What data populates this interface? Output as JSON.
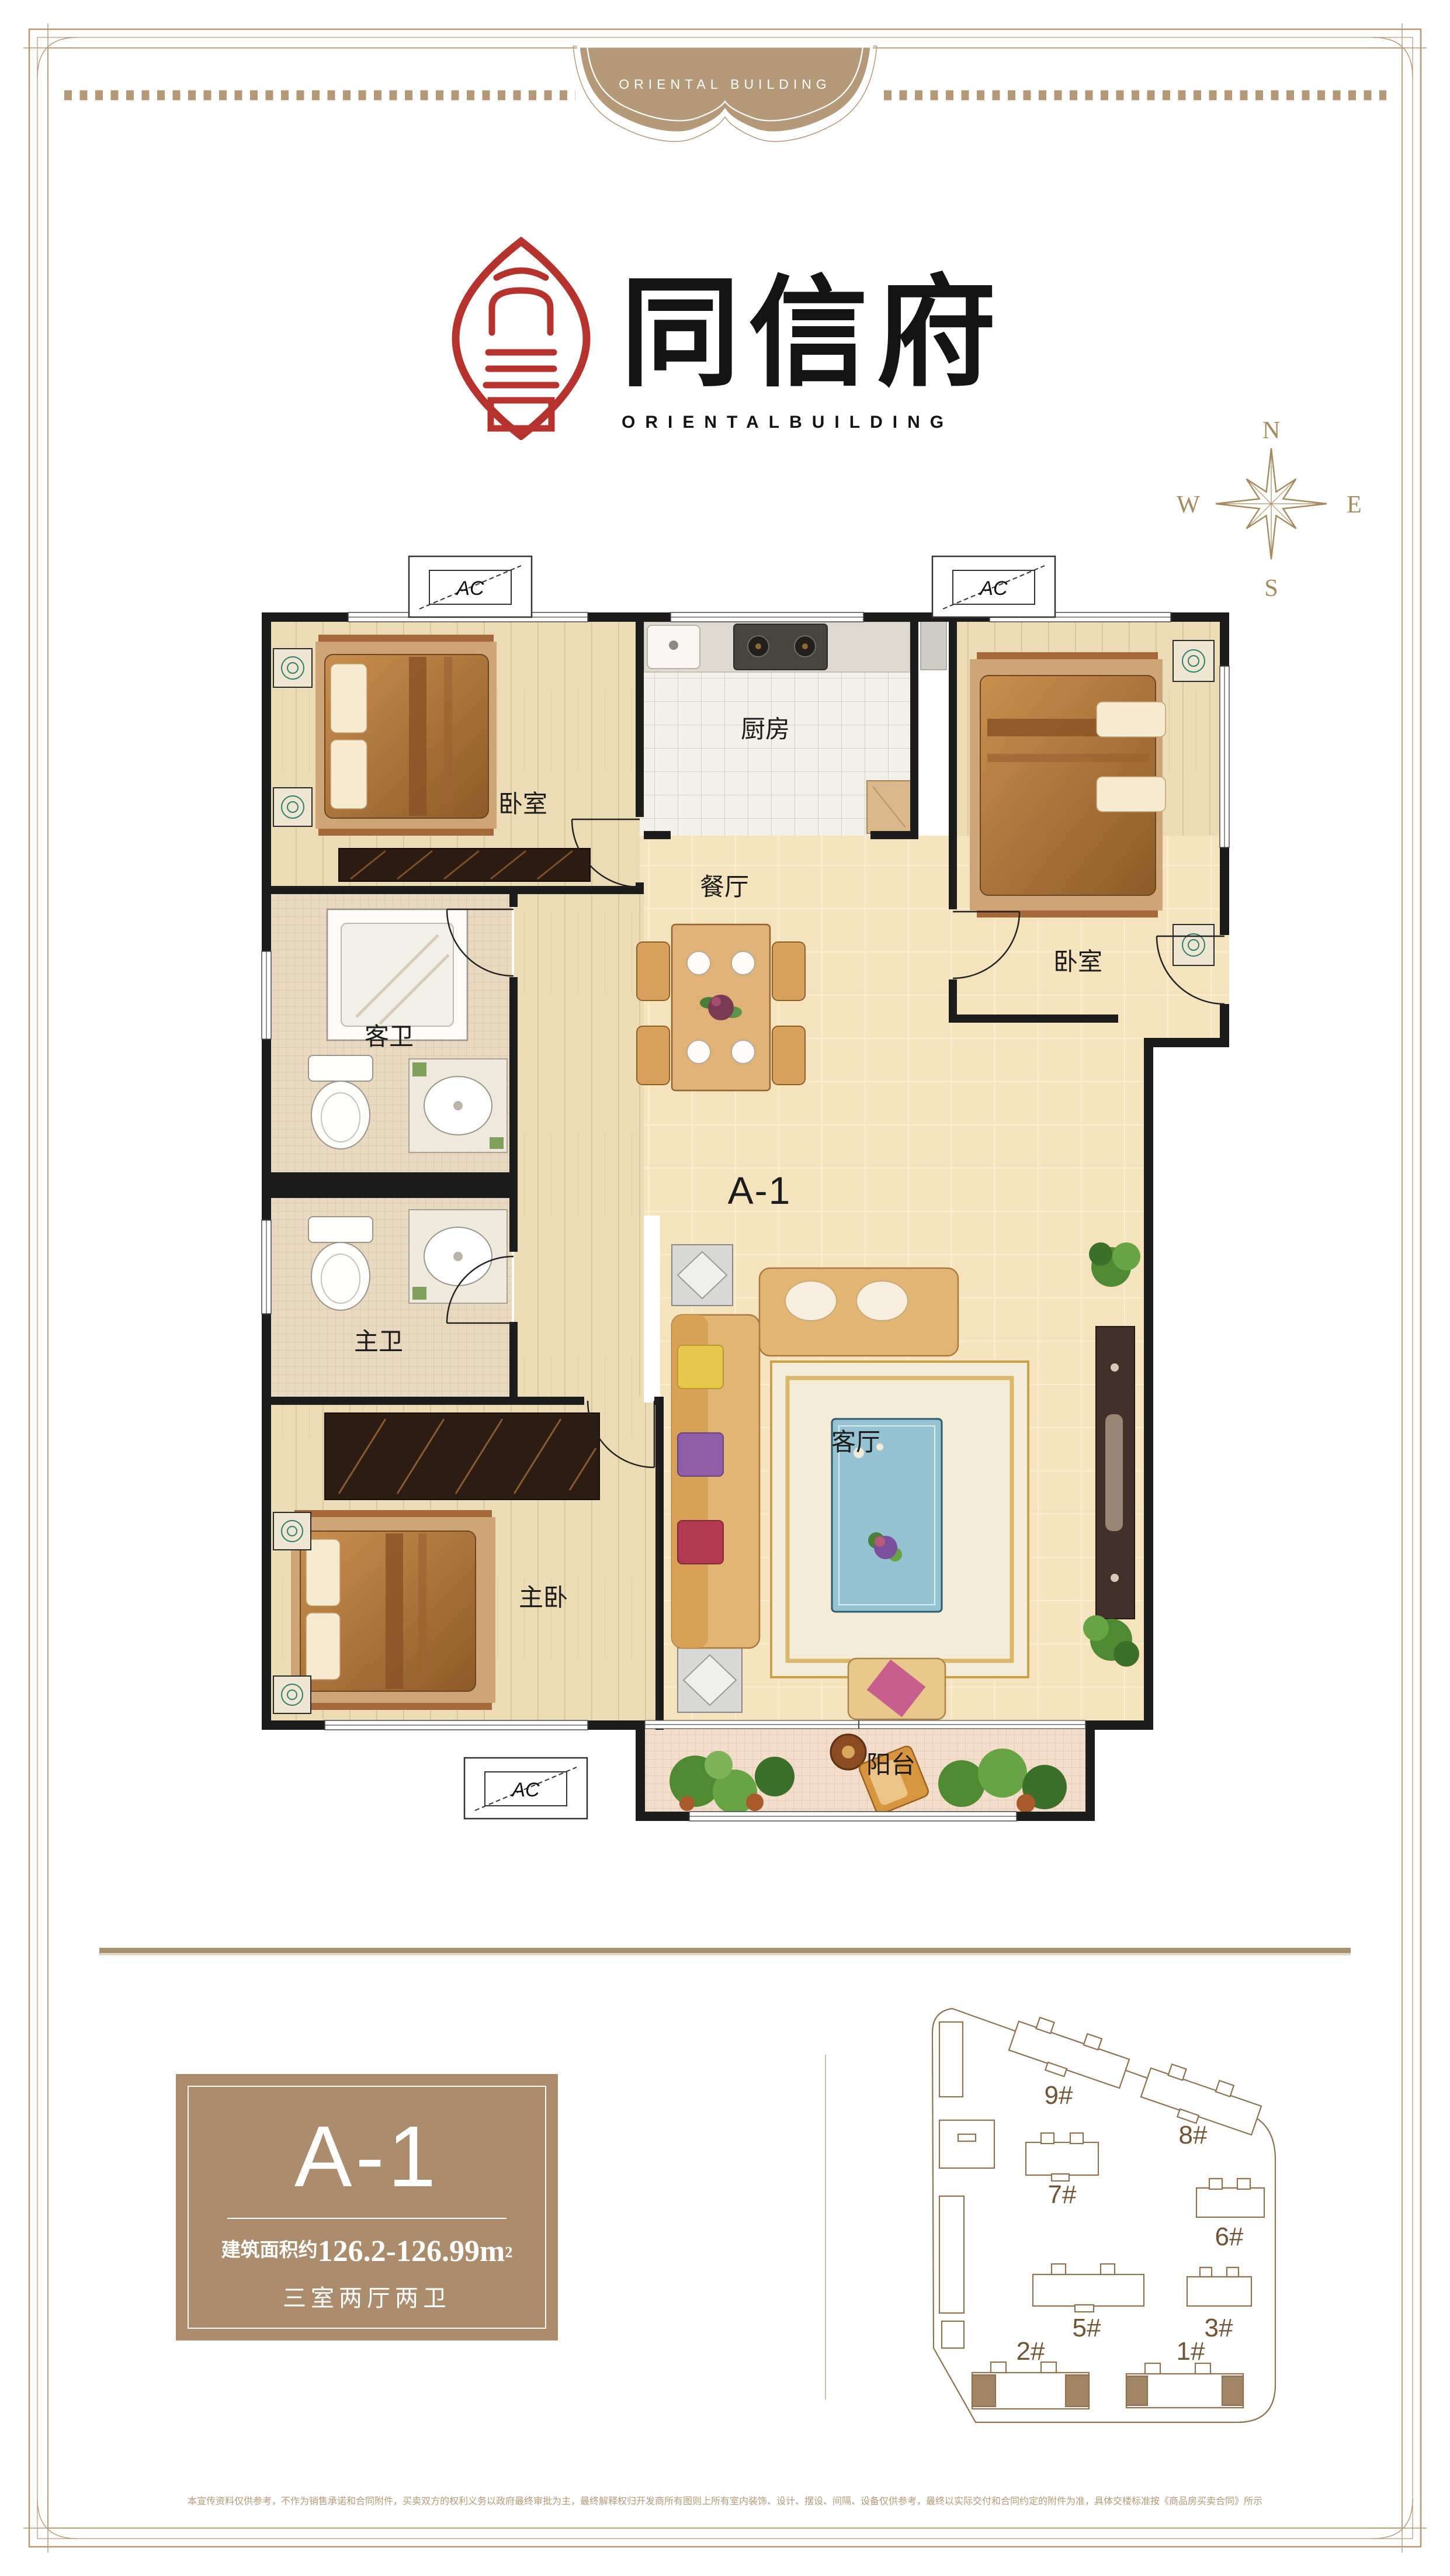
{
  "colors": {
    "frame_tan": "#b59877",
    "logo_red": "#b5332c",
    "box_brown": "#ab8d6e",
    "wall_black": "#1d1d1d",
    "site_brown": "#8d7252"
  },
  "header": {
    "banner_text": "ORIENTAL BUILDING"
  },
  "logo": {
    "cn": "同信府",
    "en": "ORIENTALBUILDING"
  },
  "compass": {
    "n": "N",
    "e": "E",
    "s": "S",
    "w": "W"
  },
  "plan": {
    "unit_label": "A-1",
    "ac_label": "AC",
    "rooms": {
      "bedroom1": "卧室",
      "kitchen": "厨房",
      "bedroom2": "卧室",
      "dining": "餐厅",
      "guest_bath": "客卫",
      "master_bath": "主卫",
      "master_bedroom": "主卧",
      "living": "客厅",
      "balcony": "阳台"
    }
  },
  "info_box": {
    "unit": "A-1",
    "area_prefix": "建筑面积约",
    "area_value": "126.2-126.99m",
    "area_sup": "2",
    "layout": "三室两厅两卫"
  },
  "site_plan": {
    "buildings": [
      {
        "label": "9#"
      },
      {
        "label": "8#"
      },
      {
        "label": "7#"
      },
      {
        "label": "6#"
      },
      {
        "label": "5#"
      },
      {
        "label": "3#"
      },
      {
        "label": "2#"
      },
      {
        "label": "1#"
      }
    ]
  },
  "disclaimer": "本宣传资料仅供参考，不作为销售承诺和合同附件，买卖双方的权利义务以政府最终审批为主，最终解释权归开发商所有图则上所有室内装饰、设计、摆设、间隔、设备仅供参考，最终以实际交付和合同约定的附件为准，具体交楼标准按《商品房买卖合同》所示"
}
